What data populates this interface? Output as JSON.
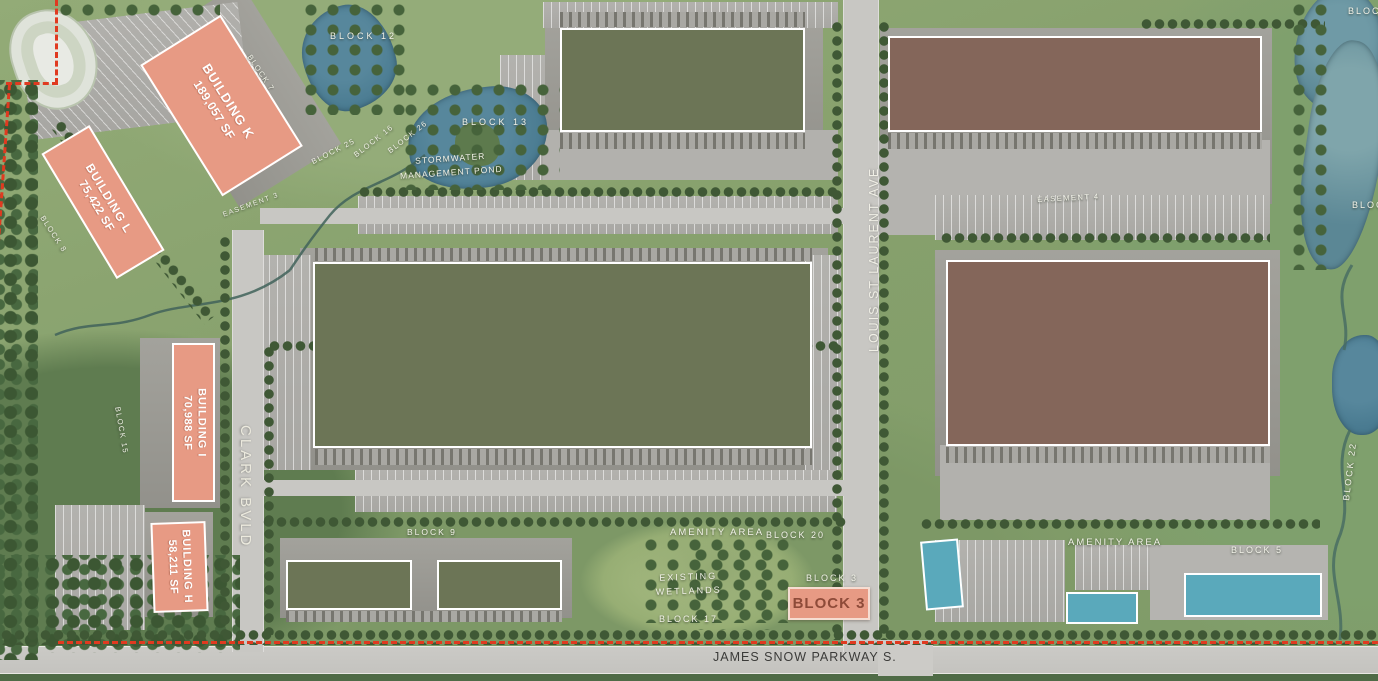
{
  "title": "Industrial Park Site Plan",
  "roads": {
    "james_snow_parkway": "JAMES SNOW PARKWAY S.",
    "clark_blvd": "CLARK BVLD",
    "louis_st_laurent_ave": "LOUIS ST LAURENT AVE"
  },
  "buildings": {
    "k": {
      "name": "BUILDING K",
      "area": "189,057 SF"
    },
    "l": {
      "name": "BUILDING L",
      "area": "75,422 SF"
    },
    "i": {
      "name": "BUILDING I",
      "area": "70,988 SF"
    },
    "h": {
      "name": "BUILDING H",
      "area": "58,211 SF"
    }
  },
  "badges": {
    "block3": "BLOCK 3"
  },
  "labels": {
    "block12": "BLOCK 12",
    "block13": "BLOCK 13",
    "stormwater_line1": "STORMWATER",
    "stormwater_line2": "MANAGEMENT POND",
    "block7": "BLOCK 7",
    "block25": "BLOCK 25",
    "block16": "BLOCK 16",
    "block26": "BLOCK 26",
    "easement3": "EASEMENT 3",
    "easement4": "EASEMENT 4",
    "block8": "BLOCK 8",
    "block15": "BLOCK 15",
    "block9": "BLOCK 9",
    "amenity_area_west": "AMENITY AREA",
    "block20": "BLOCK 20",
    "block3_area": "BLOCK 3",
    "wetlands_line1": "EXISTING",
    "wetlands_line2": "WETLANDS",
    "block17": "BLOCK 17",
    "amenity_area_east": "AMENITY AREA",
    "block5": "BLOCK 5",
    "block22": "BLOCK 22",
    "block_edge_top_right": "BLOCK",
    "block_edge_right": "BLOCK"
  },
  "colors": {
    "salmon": "#e79a84",
    "olive": "#6c7556",
    "brown": "#84665a",
    "teal": "#5aa9bb",
    "pond": "#4a7b91",
    "river": "#5b8795",
    "boundary": "#e03a20",
    "label": "#f2f2e8",
    "roadtext": "#3b3b39",
    "block3text": "#8e4b39"
  }
}
